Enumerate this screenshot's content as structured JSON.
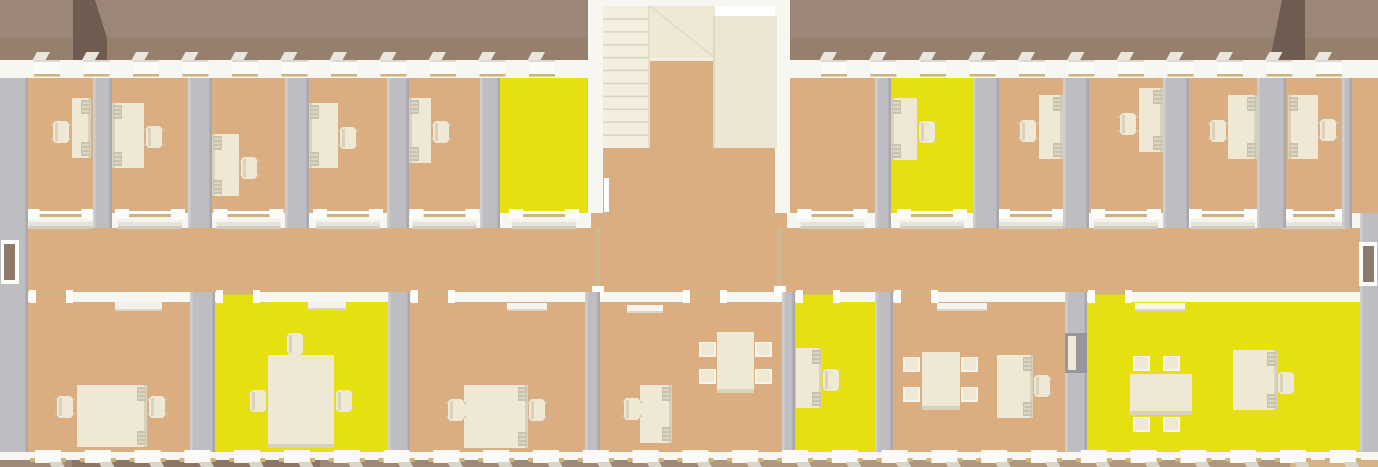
{
  "meta": {
    "scene": "3d-rendered-office-floorplan-top-down-view",
    "width": 1378,
    "height": 467,
    "description": "Long office building cutaway seen from above: two rows of offices along a central corridor, central stairwell bump-out, several rooms highlighted yellow, cream desks, chairs and meeting tables, mauve-brown roof bands at top and ground strips at bottom"
  },
  "palette": {
    "background": "#ffffff",
    "roof": "#9b8677",
    "roof_lower": "#95806e",
    "roof_dark": "#6f5c50",
    "wall_white": "#f8f6f0",
    "wall_light": "#fdfdfb",
    "wall_shadow": "#cfccc4",
    "partition": "#bdbdc2",
    "partition_light": "#cdcdd2",
    "partition_dark": "#a9a8af",
    "floor": "#dbae81",
    "floor_yellow": "#e6e010",
    "furniture": "#efe8d5",
    "furniture_shade": "#d8d1bc",
    "furniture_dark": "#c9c2ae",
    "stair": "#f3eede",
    "stair_line": "#d9d3c1",
    "trim_gold": "#cdb37c",
    "door_brown": "#8d7a6a",
    "ground_left": "#9e8878",
    "ground_patch": "#8b7565",
    "ground_mid": "#b1977b",
    "ground_right": "#d6b286"
  },
  "roof": {
    "segments": [
      [
        0,
        591
      ],
      [
        787,
        1378
      ]
    ],
    "ridge_y": 38,
    "height": 60,
    "wedges": [
      [
        [
          73,
          0
        ],
        [
          95,
          0
        ],
        [
          107,
          38
        ],
        [
          107,
          60
        ],
        [
          73,
          60
        ]
      ],
      [
        [
          1282,
          0
        ],
        [
          1305,
          0
        ],
        [
          1305,
          60
        ],
        [
          1270,
          60
        ]
      ]
    ]
  },
  "windows": {
    "top": {
      "segments": [
        [
          0,
          591
        ],
        [
          787,
          1378
        ]
      ],
      "start": 34,
      "period": 49.5,
      "w": 26
    },
    "bottom": {
      "segments": [
        [
          0,
          1378
        ]
      ],
      "start": 35,
      "period": 49.8,
      "w": 26
    }
  },
  "layout": {
    "north_wall": {
      "y": 60,
      "h": 18
    },
    "interior": {
      "x": 28,
      "w": 1332,
      "y": 78,
      "h": 374
    },
    "top_room": {
      "y": 78,
      "h": 135
    },
    "corridor": {
      "top_wall_y": 213,
      "top_wall_h": 15,
      "top_wall_segments": [
        [
          28,
          591
        ],
        [
          787,
          1360
        ]
      ],
      "bottom_wall_y": 292,
      "bottom_wall_h": 10,
      "x": 28,
      "x2": 1360
    },
    "bottom_room": {
      "y": 301,
      "h": 151
    },
    "south_wall": {
      "y": 452,
      "h": 10
    },
    "east_sliver": {
      "x": 1342,
      "y": 78,
      "w": 36,
      "h": 135
    }
  },
  "stair_hall": {
    "left_wall": [
      588,
      0,
      15,
      213
    ],
    "right_wall": [
      775,
      0,
      15,
      213
    ],
    "top_wall": [
      588,
      0,
      202,
      6
    ],
    "flight": {
      "x": 603,
      "y": 6,
      "w": 47,
      "h": 142,
      "steps": 11
    },
    "landing": [
      650,
      6,
      65,
      52
    ],
    "block": [
      713,
      16,
      64,
      132
    ],
    "void": [
      650,
      58,
      63,
      90
    ],
    "radiator": [
      604,
      178,
      5,
      34
    ],
    "wall_caps": [
      [
        596,
        228,
        4,
        62
      ],
      [
        777,
        228,
        4,
        62
      ]
    ]
  },
  "rooms_top": [
    {
      "name": "office-t1",
      "x": 28,
      "w": 65,
      "floor": "tan",
      "desk": [
        72,
        98,
        19,
        60
      ],
      "chair": [
        53,
        121
      ],
      "chair_side": "left"
    },
    {
      "name": "office-t2",
      "x": 112,
      "w": 76,
      "floor": "tan",
      "desk": [
        112,
        103,
        32,
        65
      ],
      "chair": [
        146,
        126
      ],
      "chair_side": "right"
    },
    {
      "name": "office-t3",
      "x": 212,
      "w": 73,
      "floor": "tan",
      "desk": [
        212,
        134,
        27,
        62
      ],
      "chair": [
        241,
        157
      ],
      "chair_side": "right"
    },
    {
      "name": "office-t4",
      "x": 309,
      "w": 78,
      "floor": "tan",
      "desk": [
        309,
        103,
        29,
        65
      ],
      "chair": [
        340,
        127
      ],
      "chair_side": "right"
    },
    {
      "name": "office-t5",
      "x": 409,
      "w": 71,
      "floor": "tan",
      "desk": [
        409,
        98,
        22,
        65
      ],
      "chair": [
        433,
        121
      ],
      "chair_side": "right"
    },
    {
      "name": "office-t6",
      "x": 500,
      "w": 88,
      "floor": "yellow"
    },
    {
      "name": "office-t7",
      "x": 790,
      "w": 85,
      "floor": "tan"
    },
    {
      "name": "office-t8",
      "x": 891,
      "w": 82,
      "floor": "yellow",
      "desk": [
        891,
        98,
        26,
        62
      ],
      "chair": [
        919,
        121
      ],
      "chair_side": "right"
    },
    {
      "name": "office-t9",
      "x": 999,
      "w": 64,
      "floor": "tan",
      "desk": [
        1039,
        95,
        24,
        64
      ],
      "chair": [
        1020,
        120
      ],
      "chair_side": "left"
    },
    {
      "name": "office-t10",
      "x": 1089,
      "w": 74,
      "floor": "tan",
      "desk": [
        1139,
        88,
        24,
        64
      ],
      "chair": [
        1120,
        113
      ],
      "chair_side": "left"
    },
    {
      "name": "office-t11",
      "x": 1189,
      "w": 68,
      "floor": "tan",
      "desk": [
        1228,
        95,
        29,
        64
      ],
      "chair": [
        1210,
        120
      ],
      "chair_side": "left"
    },
    {
      "name": "office-t12",
      "x": 1286,
      "w": 56,
      "floor": "tan",
      "desk": [
        1288,
        95,
        30,
        64
      ],
      "chair": [
        1320,
        119
      ],
      "chair_side": "right"
    },
    {
      "name": "office-t13",
      "x": 1352,
      "w": 26,
      "floor": "tan",
      "no_door": true
    }
  ],
  "partitions_top": [
    [
      93,
      19
    ],
    [
      188,
      24
    ],
    [
      285,
      24
    ],
    [
      387,
      22
    ],
    [
      480,
      20
    ],
    [
      875,
      16
    ],
    [
      973,
      26
    ],
    [
      1063,
      26
    ],
    [
      1163,
      26
    ],
    [
      1257,
      29
    ],
    [
      1342,
      10
    ]
  ],
  "rooms_bottom": [
    {
      "name": "office-b1",
      "x": 28,
      "w": 162,
      "floor": "tan",
      "door_x": 34,
      "items": [
        [
          "sideboard",
          115,
          302,
          47,
          9
        ],
        [
          "desk",
          77,
          385,
          70,
          62,
          "right"
        ],
        [
          "ochair",
          57,
          396
        ],
        [
          "ochair",
          149,
          396
        ]
      ]
    },
    {
      "name": "meeting-b2",
      "x": 215,
      "w": 173,
      "floor": "yellow",
      "door_x": 221,
      "items": [
        [
          "sideboard",
          308,
          302,
          38,
          8
        ],
        [
          "table",
          268,
          355,
          66,
          93
        ],
        [
          "ochair",
          250,
          390
        ],
        [
          "ochair",
          336,
          390
        ],
        [
          "ochair",
          287,
          333
        ]
      ]
    },
    {
      "name": "office-b3",
      "x": 410,
      "w": 175,
      "floor": "tan",
      "door_x": 416,
      "items": [
        [
          "leaf",
          507,
          303,
          40,
          8
        ],
        [
          "desk",
          464,
          385,
          64,
          63,
          "right"
        ],
        [
          "ochair",
          448,
          399
        ],
        [
          "ochair",
          529,
          399
        ]
      ]
    },
    {
      "name": "office-b4",
      "x": 600,
      "w": 182,
      "floor": "tan",
      "door_x": 688,
      "items": [
        [
          "leaf",
          627,
          305,
          36,
          8
        ],
        [
          "desk",
          640,
          385,
          32,
          58,
          "right"
        ],
        [
          "ochair",
          624,
          398
        ],
        [
          "table",
          717,
          332,
          37,
          61
        ],
        [
          "mchair",
          699,
          342
        ],
        [
          "mchair",
          699,
          369
        ],
        [
          "mchair",
          755,
          342
        ],
        [
          "mchair",
          755,
          369
        ]
      ]
    },
    {
      "name": "office-b5",
      "x": 795,
      "w": 80,
      "floor": "yellow",
      "door_x": 801,
      "items": [
        [
          "desk",
          796,
          348,
          26,
          60,
          "right"
        ],
        [
          "ochair",
          823,
          369
        ]
      ]
    },
    {
      "name": "office-b6",
      "x": 893,
      "w": 172,
      "floor": "tan",
      "door_x": 899,
      "items": [
        [
          "leaf",
          937,
          303,
          50,
          8
        ],
        [
          "table",
          922,
          352,
          38,
          58
        ],
        [
          "mchair",
          903,
          357
        ],
        [
          "mchair",
          903,
          387
        ],
        [
          "mchair",
          961,
          357
        ],
        [
          "mchair",
          961,
          387
        ],
        [
          "desk",
          997,
          355,
          36,
          63,
          "right"
        ],
        [
          "ochair",
          1034,
          375
        ]
      ]
    },
    {
      "name": "meeting-b7",
      "x": 1087,
      "w": 273,
      "floor": "yellow",
      "door_x": 1093,
      "items": [
        [
          "leaf",
          1135,
          303,
          50,
          8
        ],
        [
          "table",
          1130,
          374,
          62,
          41
        ],
        [
          "mchair",
          1133,
          356
        ],
        [
          "mchair",
          1163,
          356
        ],
        [
          "mchair",
          1133,
          417
        ],
        [
          "mchair",
          1163,
          417
        ],
        [
          "desk",
          1233,
          350,
          44,
          60,
          "right"
        ],
        [
          "ochair",
          1278,
          372
        ]
      ]
    }
  ],
  "partitions_bottom": [
    [
      190,
      25
    ],
    [
      388,
      22
    ],
    [
      585,
      15
    ],
    [
      782,
      13
    ],
    [
      875,
      18
    ],
    [
      1065,
      22
    ]
  ],
  "partition_opening_b6_b7": [
    1065,
    333,
    22,
    40
  ],
  "end_walls": {
    "west_block": [
      0,
      78,
      28,
      377
    ],
    "east_block": [
      1360,
      213,
      18,
      242
    ],
    "west_door": {
      "frame": [
        1,
        240,
        18,
        44
      ],
      "leaf": [
        4,
        244,
        11,
        36
      ]
    },
    "east_door": {
      "frame": [
        1359,
        242,
        18,
        44
      ],
      "leaf": [
        1363,
        246,
        11,
        36
      ]
    }
  },
  "ground": {
    "strips": [
      [
        0,
        710,
        "ground_left"
      ],
      [
        710,
        1290,
        "ground_mid"
      ],
      [
        1290,
        1378,
        "ground_right"
      ]
    ],
    "patch": [
      72,
      460,
      248,
      7
    ]
  }
}
